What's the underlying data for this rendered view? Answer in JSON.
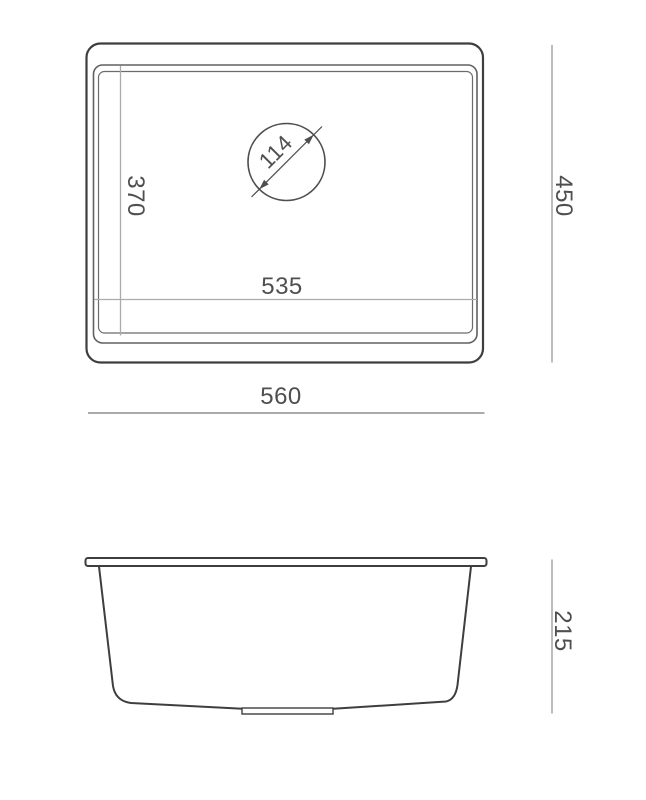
{
  "drawing": {
    "top_view": {
      "overall_width": "560",
      "overall_depth": "450",
      "bowl_width": "535",
      "bowl_depth": "370",
      "drain_diameter": "114"
    },
    "side_view": {
      "overall_height": "215"
    },
    "colors": {
      "outline_dark": "#3e3e3e",
      "rim_line": "#616161",
      "reference_line_light": "#ababab",
      "dimension_line": "#8f8f8f",
      "label_text": "#4f4f4f",
      "background": "#ffffff"
    }
  }
}
